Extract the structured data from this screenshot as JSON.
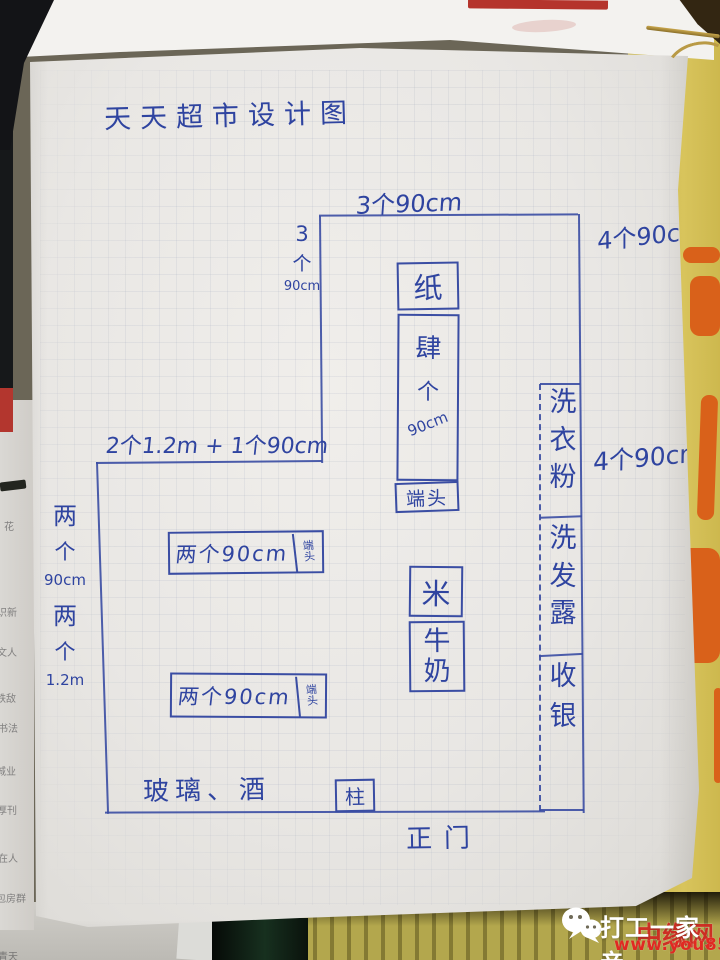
{
  "diagram": {
    "title": "天天超市设计图",
    "top_width_label": "3个90cm",
    "top_right_label": "4个90cm",
    "left_top_count": [
      "3",
      "个",
      "90cm"
    ],
    "mid_width_label": "2个1.2m + 1个90cm",
    "left_side_a": [
      "两",
      "个",
      "90cm"
    ],
    "left_side_b": [
      "两",
      "个",
      "1.2m"
    ],
    "right_mid_label": "4个90cm",
    "glass_wine_label": "玻璃、酒",
    "pillar_label": "柱",
    "entrance_label": "正门",
    "paper_shelf": "纸",
    "center_shelf": [
      "肆",
      "个",
      "90cm"
    ],
    "center_endcap": "端头",
    "rice_box": "米",
    "milk_box": [
      "牛",
      "奶"
    ],
    "laundry_column": [
      "洗",
      "衣",
      "粉"
    ],
    "shampoo_column": [
      "洗",
      "发",
      "露"
    ],
    "cashier_column": [
      "收",
      "银"
    ],
    "shelf1_label": "两个90cm",
    "shelf1_endcap": [
      "端",
      "头"
    ],
    "shelf2_label": "两个90cm",
    "shelf2_endcap": [
      "端",
      "头"
    ]
  },
  "underlying_page_fragments": [
    "花",
    "识新",
    "文人",
    "铁敌",
    "书法",
    "城业",
    "厚刊",
    "在人",
    "包房群",
    "青天"
  ],
  "watermark": {
    "brand": "打工一家亲",
    "overlay_text": "中缘网",
    "site": "www.you85.com"
  },
  "colors": {
    "ink": "#2f44a0",
    "paper": "#e9e7e4",
    "poster_yellow": "#d3bf55",
    "poster_orange": "#d9611a",
    "red_bar": "#b5342c",
    "watermark_red": "#d8241c"
  }
}
